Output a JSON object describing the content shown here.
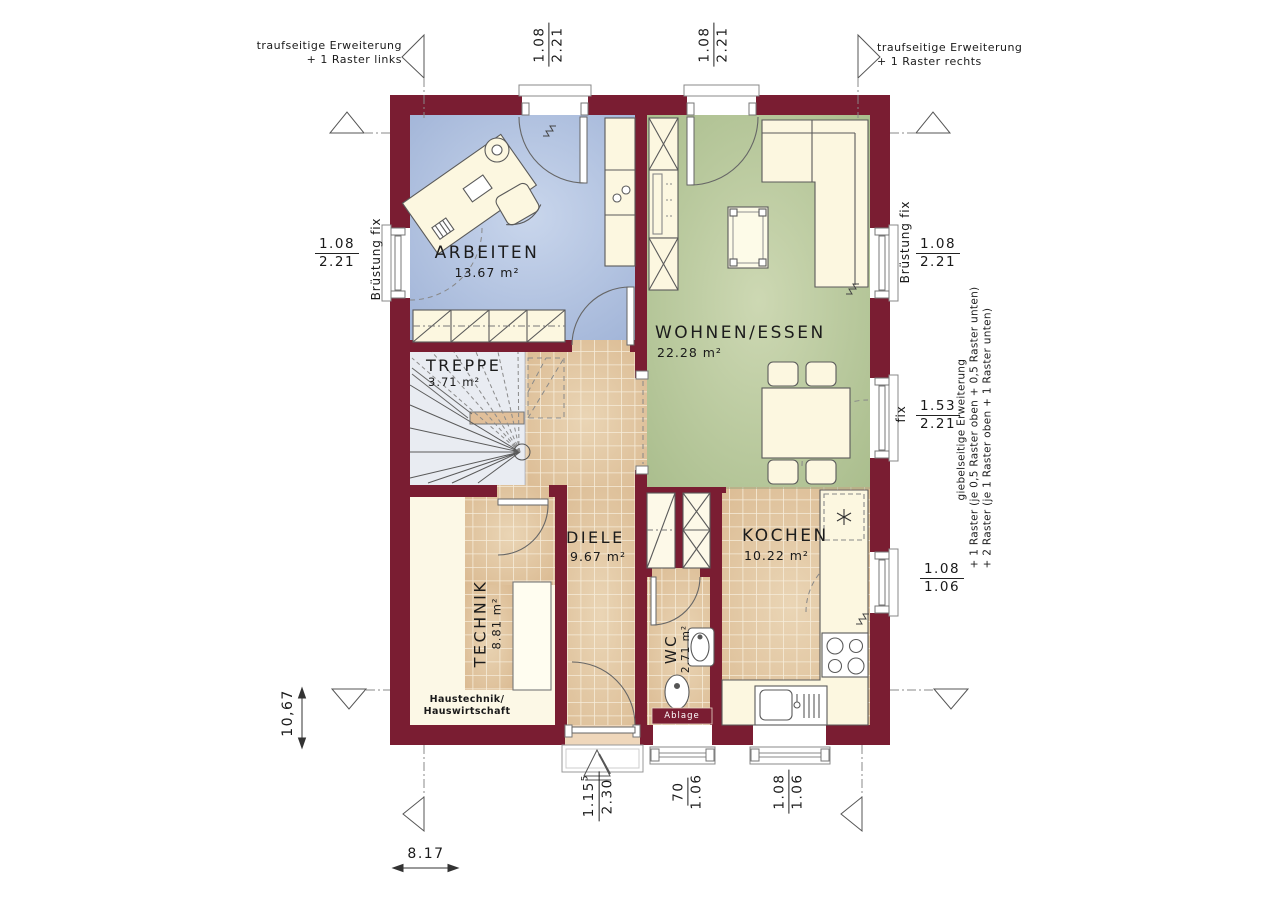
{
  "rooms": {
    "arbeiten": {
      "name": "ARBEITEN",
      "area": "13.67 m²"
    },
    "wohnen_essen": {
      "name": "WOHNEN/ESSEN",
      "area": "22.28 m²"
    },
    "treppe": {
      "name": "TREPPE",
      "area": "3.71 m²"
    },
    "diele": {
      "name": "DIELE",
      "area": "9.67 m²"
    },
    "technik": {
      "name": "TECHNIK",
      "area": "8.81 m²",
      "note_line1": "Haustechnik/",
      "note_line2": "Hauswirtschaft"
    },
    "wc": {
      "name": "WC",
      "area": "2.71 m²",
      "shelf_label": "Ablage"
    },
    "kochen": {
      "name": "KOCHEN",
      "area": "10.22 m²"
    }
  },
  "annotations": {
    "top_left": {
      "line1": "traufseitige Erweiterung",
      "line2": "+ 1 Raster links"
    },
    "top_right": {
      "line1": "traufseitige Erweiterung",
      "line2": "+ 1 Raster rechts"
    },
    "right_gable": {
      "line1": "giebelseitige Erweiterung",
      "line2": "+ 1 Raster (je 0,5 Raster oben + 0,5 Raster unten)",
      "line3": "+ 2 Raster (je 1 Raster oben + 1 Raster unten)"
    }
  },
  "window_labels": {
    "left": "Brüstung fix",
    "right_upper": "Brüstung fix",
    "right_mid": "fix"
  },
  "dimensions": {
    "door_top_left": {
      "width": "1.08",
      "height": "2.21"
    },
    "door_top_right": {
      "width": "1.08",
      "height": "2.21"
    },
    "window_left": {
      "width": "1.08",
      "height": "2.21"
    },
    "window_right_upper": {
      "width": "1.08",
      "height": "2.21"
    },
    "window_right_mid": {
      "width": "1.53",
      "height": "2.21"
    },
    "window_right_lower": {
      "width": "1.08",
      "height": "1.06"
    },
    "entry_door": {
      "width": "1.15",
      "width_sup": "5",
      "height": "2.30"
    },
    "window_wc": {
      "width": "70",
      "height": "1.06"
    },
    "window_kitchen": {
      "width": "1.08",
      "height": "1.06"
    },
    "overall_width": "8.17",
    "overall_depth": "10,67"
  },
  "colors": {
    "wall": "#7a1d32",
    "floor_arbeiten": "#b7c6e2",
    "floor_wohnen": "#bccb9e",
    "floor_tiles": "#e0bf9a",
    "floor_treppe": "#e9ecf2",
    "furniture": "#fcf7e0"
  }
}
